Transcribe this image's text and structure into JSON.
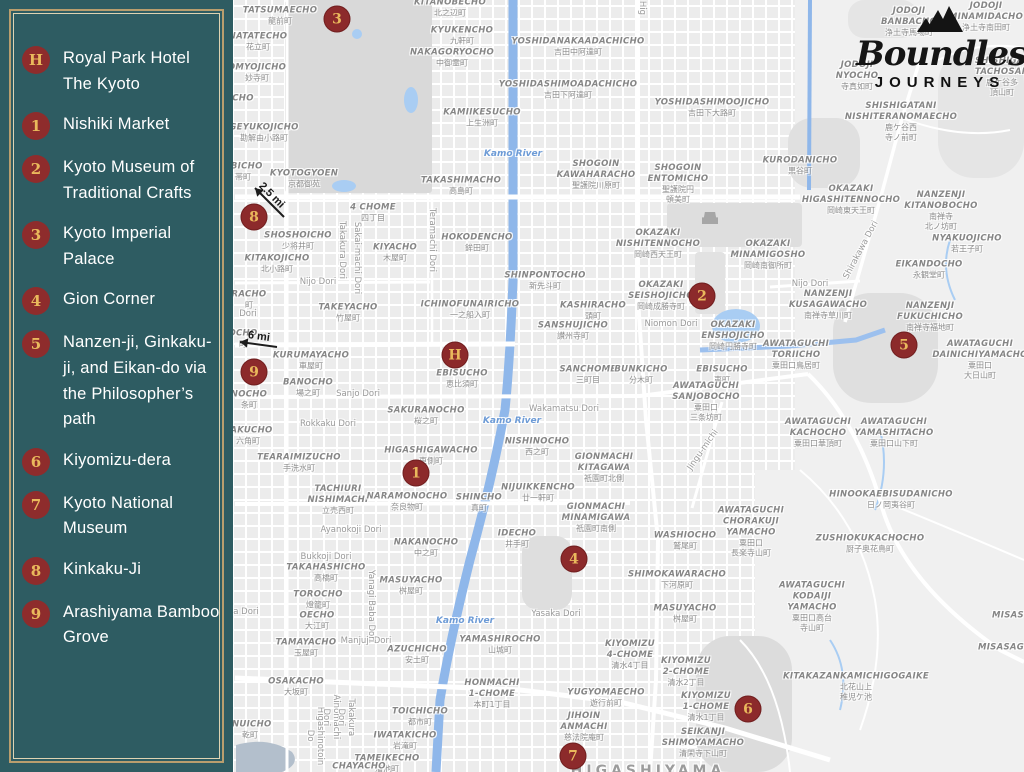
{
  "sidebar": {
    "items": [
      {
        "id": "H",
        "label": "Royal Park Hotel The Kyoto"
      },
      {
        "id": "1",
        "label": "Nishiki Market"
      },
      {
        "id": "2",
        "label": "Kyoto Museum of Traditional Crafts"
      },
      {
        "id": "3",
        "label": "Kyoto Imperial Palace"
      },
      {
        "id": "4",
        "label": "Gion Corner"
      },
      {
        "id": "5",
        "label": "Nanzen-ji, Ginkaku-ji, and Eikan-do via the Philosopher’s path"
      },
      {
        "id": "6",
        "label": "Kiyomizu-dera"
      },
      {
        "id": "7",
        "label": "Kyoto National Museum"
      },
      {
        "id": "8",
        "label": "Kinkaku-Ji"
      },
      {
        "id": "9",
        "label": "Arashiyama Bamboo Grove"
      }
    ]
  },
  "logo": {
    "line1": "Boundless",
    "line2": "JOURNEYS",
    "icon": "mountains-icon"
  },
  "colors": {
    "sidebar_bg": "#2e5c62",
    "frame_gold": "#b99e6e",
    "frame_inner": "#dfd3b2",
    "marker_red": "#8c2a2b",
    "marker_gold": "#eab95c",
    "label_gray": "#868686",
    "water_blue": "#8fb7ea",
    "road_white": "#ffffff",
    "park_gray": "#d9d9d9",
    "logo_black": "#151515"
  },
  "map": {
    "markers": [
      {
        "id": "3",
        "x": 337,
        "y": 19
      },
      {
        "id": "8",
        "x": 254,
        "y": 217
      },
      {
        "id": "9",
        "x": 254,
        "y": 372
      },
      {
        "id": "H",
        "x": 455,
        "y": 355
      },
      {
        "id": "2",
        "x": 702,
        "y": 296
      },
      {
        "id": "5",
        "x": 904,
        "y": 345
      },
      {
        "id": "1",
        "x": 416,
        "y": 473
      },
      {
        "id": "4",
        "x": 574,
        "y": 559
      },
      {
        "id": "6",
        "x": 748,
        "y": 709
      },
      {
        "id": "7",
        "x": 573,
        "y": 756
      }
    ],
    "arrows": [
      {
        "label": "2.5 mi",
        "tx": 284,
        "ty": 217,
        "hx": 255,
        "hy": 188
      },
      {
        "label": "6 mi",
        "tx": 277,
        "ty": 347,
        "hx": 240,
        "hy": 342
      }
    ],
    "labels": [
      {
        "en": "TATSUMAECHO",
        "jp": "龍前町",
        "x": 280,
        "y": 16,
        "t": "d"
      },
      {
        "en": "NATATECHO",
        "jp": "花立町",
        "x": 258,
        "y": 42,
        "t": "d"
      },
      {
        "en": "OMYOJICHO",
        "jp": "妙寺町",
        "x": 257,
        "y": 73,
        "t": "d"
      },
      {
        "en": "CHO",
        "x": 243,
        "y": 99,
        "t": "d"
      },
      {
        "en": "GEYUKOJICHO",
        "jp": "勘解由小路町",
        "x": 264,
        "y": 133,
        "t": "d"
      },
      {
        "en": "OBICHO",
        "jp": "帯町",
        "x": 243,
        "y": 172,
        "t": "d"
      },
      {
        "en": "KYOTOGYOEN",
        "jp": "京都御苑",
        "x": 304,
        "y": 179,
        "t": "d"
      },
      {
        "en": "KITANOBECHO",
        "jp": "北之辺町",
        "x": 450,
        "y": 8,
        "t": "d"
      },
      {
        "en": "KYUKENCHO",
        "jp": "九軒町",
        "x": 462,
        "y": 36,
        "t": "d"
      },
      {
        "en": "NAKAGORYOCHO",
        "jp": "中御霊町",
        "x": 452,
        "y": 58,
        "t": "d"
      },
      {
        "en": "YOSHIDANAKAADACHICHO",
        "jp": "吉田中阿達町",
        "x": 578,
        "y": 47,
        "t": "d"
      },
      {
        "en": "YOSHIDASHIMOADACHICHO",
        "jp": "吉田下阿達町",
        "x": 568,
        "y": 90,
        "t": "d"
      },
      {
        "en": "YOSHIDASHIMOOJICHO",
        "jp": "吉田下大路町",
        "x": 712,
        "y": 108,
        "t": "d"
      },
      {
        "en": "KAMIIKESUCHO",
        "jp": "上生洲町",
        "x": 482,
        "y": 118,
        "t": "d"
      },
      {
        "en": "Kamo River",
        "x": 513,
        "y": 154,
        "t": "w"
      },
      {
        "en": "TAKASHIMACHO",
        "jp": "高島町",
        "x": 461,
        "y": 186,
        "t": "d"
      },
      {
        "en": "SHOGOIN\nKAWAHARACHO",
        "jp": "聖護院川原町",
        "x": 596,
        "y": 175,
        "t": "d"
      },
      {
        "en": "SHOGOIN\nENTOMICHO",
        "jp": "聖護院円\n頓美町",
        "x": 678,
        "y": 184,
        "t": "d"
      },
      {
        "en": "KURODANICHO",
        "jp": "黒谷町",
        "x": 800,
        "y": 166,
        "t": "d"
      },
      {
        "en": "JODOJI\nBANBACHO",
        "jp": "浄土寺馬場町",
        "x": 909,
        "y": 22,
        "t": "d"
      },
      {
        "en": "JODOJI\nMINAMIDACHO",
        "jp": "浄土寺南田町",
        "x": 986,
        "y": 17,
        "t": "d"
      },
      {
        "en": "SHISHIGAT\nTACHOSAN",
        "jp": "鹿ケ谷多\n頂山町",
        "x": 1002,
        "y": 77,
        "t": "d"
      },
      {
        "en": "JODOJI\nNYOCHO",
        "jp": "寺真如町",
        "x": 857,
        "y": 76,
        "t": "d"
      },
      {
        "en": "SHISHIGATANI\nNISHITERANOMAECHO",
        "jp": "鹿ケ谷西\n寺ノ前町",
        "x": 901,
        "y": 122,
        "t": "d"
      },
      {
        "en": "OKAZAKI\nHIGASHITENNOCHO",
        "jp": "岡崎東天王町",
        "x": 851,
        "y": 200,
        "t": "d"
      },
      {
        "en": "NANZENJI\nKITANOBOCHO",
        "jp": "南禅寺\n北ノ坊町",
        "x": 941,
        "y": 211,
        "t": "d"
      },
      {
        "en": "NYAKUOJICHO",
        "jp": "若王子町",
        "x": 967,
        "y": 244,
        "t": "d"
      },
      {
        "en": "EIKANDOCHO",
        "jp": "永観堂町",
        "x": 929,
        "y": 270,
        "t": "d"
      },
      {
        "en": "NANZENJI\nKUSAGAWACHO",
        "jp": "南禅寺草川町",
        "x": 828,
        "y": 305,
        "t": "d"
      },
      {
        "en": "NANZENJI\nFUKUCHICHO",
        "jp": "南禅寺福地町",
        "x": 930,
        "y": 317,
        "t": "d"
      },
      {
        "en": "AWATAGUCHI\nDAINICHIYAMACHO",
        "jp": "粟田口\n大日山町",
        "x": 980,
        "y": 360,
        "t": "d"
      },
      {
        "en": "AWATAGUCHI\nTORIICHO",
        "jp": "粟田口鳥居町",
        "x": 796,
        "y": 355,
        "t": "d"
      },
      {
        "en": "AWATAGUCHI\nKACHOCHO",
        "jp": "粟田口華頂町",
        "x": 818,
        "y": 433,
        "t": "d"
      },
      {
        "en": "AWATAGUCHI\nYAMASHITACHO",
        "jp": "粟田口山下町",
        "x": 894,
        "y": 433,
        "t": "d"
      },
      {
        "en": "HINOOKAEBISUDANICHO",
        "jp": "日ノ岡夷谷町",
        "x": 891,
        "y": 500,
        "t": "d"
      },
      {
        "en": "ZUSHIOKUKACHOCHO",
        "jp": "厨子奥花鳥町",
        "x": 870,
        "y": 544,
        "t": "d"
      },
      {
        "en": "AWATAGUCHI\nKODAIJI\nYAMACHO",
        "jp": "粟田口高台\n寺山町",
        "x": 812,
        "y": 607,
        "t": "d"
      },
      {
        "en": "MISAS",
        "x": 1008,
        "y": 616,
        "t": "d"
      },
      {
        "en": "MISASAG",
        "x": 1001,
        "y": 648,
        "t": "d"
      },
      {
        "en": "KITAKAZANKAMICHIGOGAIKE",
        "jp": "北花山上\n稚児ケ池",
        "x": 856,
        "y": 687,
        "t": "d"
      },
      {
        "en": "SHINPONTOCHO",
        "jp": "新先斗町",
        "x": 545,
        "y": 281,
        "t": "d"
      },
      {
        "en": "OKAZAKI\nNISHITENNOCHO",
        "jp": "岡崎西天王町",
        "x": 658,
        "y": 244,
        "t": "d"
      },
      {
        "en": "OKAZAKI\nMINAMIGOSHO",
        "jp": "岡崎南御所町",
        "x": 768,
        "y": 255,
        "t": "d"
      },
      {
        "en": "OKAZAKI\nSEISHOJICHO",
        "jp": "岡崎成勝寺町",
        "x": 661,
        "y": 296,
        "t": "d"
      },
      {
        "en": "KASHIRACHO",
        "jp": "頭町",
        "x": 593,
        "y": 311,
        "t": "d"
      },
      {
        "en": "SANSHUJICHO",
        "jp": "讃州寺町",
        "x": 573,
        "y": 331,
        "t": "d"
      },
      {
        "en": "Niomon Dori",
        "x": 671,
        "y": 324,
        "t": "r"
      },
      {
        "en": "OKAZAKI\nENSHOJICHO",
        "jp": "岡崎円勝寺町",
        "x": 733,
        "y": 336,
        "t": "d"
      },
      {
        "en": "SANCHOME",
        "jp": "三町目",
        "x": 588,
        "y": 375,
        "t": "d"
      },
      {
        "en": "BUNKICHO",
        "jp": "分木町",
        "x": 641,
        "y": 375,
        "t": "d"
      },
      {
        "en": "EBISUCHO",
        "jp": "夷町",
        "x": 722,
        "y": 375,
        "t": "d"
      },
      {
        "en": "AWATAGUCHI\nSANJOBOCHO",
        "jp": "粟田口\n三条坊町",
        "x": 706,
        "y": 402,
        "t": "d"
      },
      {
        "en": "Wakamatsu Dori",
        "x": 564,
        "y": 409,
        "t": "r"
      },
      {
        "en": "4 CHOME",
        "jp": "四丁目",
        "x": 373,
        "y": 213,
        "t": "d"
      },
      {
        "en": "SHOSHOICHO",
        "jp": "少将井町",
        "x": 298,
        "y": 241,
        "t": "d"
      },
      {
        "en": "KITAKOJICHO",
        "jp": "北小路町",
        "x": 277,
        "y": 264,
        "t": "d"
      },
      {
        "en": "Nijo Dori",
        "x": 318,
        "y": 282,
        "t": "r"
      },
      {
        "en": "Nijo Dori",
        "x": 810,
        "y": 284,
        "t": "r"
      },
      {
        "en": "KIYACHO",
        "jp": "木屋町",
        "x": 395,
        "y": 253,
        "t": "d"
      },
      {
        "en": "HOKODENCHO",
        "jp": "鉾田町",
        "x": 477,
        "y": 243,
        "t": "d"
      },
      {
        "en": "TAKEYACHO",
        "jp": "竹屋町",
        "x": 348,
        "y": 313,
        "t": "d"
      },
      {
        "en": "ICHINOFUNAIRICHO",
        "jp": "一之船入町",
        "x": 470,
        "y": 310,
        "t": "d"
      },
      {
        "en": "KURUMAYACHO",
        "jp": "車屋町",
        "x": 311,
        "y": 361,
        "t": "d"
      },
      {
        "en": "BANOCHO",
        "jp": "場之町",
        "x": 308,
        "y": 388,
        "t": "d"
      },
      {
        "en": "Sanjo Dori",
        "x": 358,
        "y": 394,
        "t": "r"
      },
      {
        "en": "EBISUCHO",
        "jp": "恵比須町",
        "x": 462,
        "y": 379,
        "t": "d"
      },
      {
        "en": "RACHO",
        "jp": "町",
        "x": 249,
        "y": 300,
        "t": "d"
      },
      {
        "en": "Dori",
        "x": 248,
        "y": 314,
        "t": "r"
      },
      {
        "en": "OCHO",
        "jp": "町",
        "x": 243,
        "y": 339,
        "t": "d"
      },
      {
        "en": "NOCHO",
        "jp": "条町",
        "x": 249,
        "y": 400,
        "t": "d"
      },
      {
        "en": "SAKURANOCHO",
        "jp": "桜之町",
        "x": 426,
        "y": 416,
        "t": "d"
      },
      {
        "en": "Rokkaku Dori",
        "x": 328,
        "y": 424,
        "t": "r"
      },
      {
        "en": "KAKUCHO",
        "jp": "六角町",
        "x": 248,
        "y": 436,
        "t": "d"
      },
      {
        "en": "TEARAIMIZUCHO",
        "jp": "手洗水町",
        "x": 299,
        "y": 463,
        "t": "d"
      },
      {
        "en": "HIGASHIGAWACHO",
        "jp": "東側町",
        "x": 431,
        "y": 456,
        "t": "d"
      },
      {
        "en": "Kamo River",
        "x": 512,
        "y": 421,
        "t": "w"
      },
      {
        "en": "TACHIURI\nNISHIMACHI",
        "jp": "立売西町",
        "x": 338,
        "y": 500,
        "t": "d"
      },
      {
        "en": "NARAMONOCHO",
        "jp": "奈良物町",
        "x": 407,
        "y": 502,
        "t": "d"
      },
      {
        "en": "SHINCHO",
        "jp": "真町",
        "x": 479,
        "y": 503,
        "t": "d"
      },
      {
        "en": "Ayanokoji Dori",
        "x": 351,
        "y": 530,
        "t": "r"
      },
      {
        "en": "NAKANOCHO",
        "jp": "中之町",
        "x": 426,
        "y": 548,
        "t": "d"
      },
      {
        "en": "Bukkoji Dori",
        "x": 326,
        "y": 557,
        "t": "r"
      },
      {
        "en": "TAKAHASHICHO",
        "jp": "高橋町",
        "x": 326,
        "y": 573,
        "t": "d"
      },
      {
        "en": "MASUYACHO",
        "jp": "桝屋町",
        "x": 411,
        "y": 586,
        "t": "d"
      },
      {
        "en": "TOROCHO",
        "jp": "燈籠町",
        "x": 318,
        "y": 600,
        "t": "d"
      },
      {
        "en": "OECHO",
        "jp": "大江町",
        "x": 317,
        "y": 621,
        "t": "d"
      },
      {
        "en": "TAMAYACHO",
        "jp": "玉屋町",
        "x": 306,
        "y": 648,
        "t": "d"
      },
      {
        "en": "Manjuji Dori",
        "x": 366,
        "y": 641,
        "t": "r"
      },
      {
        "en": "AZUCHICHO",
        "jp": "安土町",
        "x": 417,
        "y": 655,
        "t": "d"
      },
      {
        "en": "Kamo River",
        "x": 465,
        "y": 621,
        "t": "w"
      },
      {
        "en": "YAMASHIROCHO",
        "jp": "山城町",
        "x": 500,
        "y": 645,
        "t": "d"
      },
      {
        "en": "a Dori",
        "x": 246,
        "y": 612,
        "t": "r"
      },
      {
        "en": "OSAKACHO",
        "jp": "大坂町",
        "x": 296,
        "y": 687,
        "t": "d"
      },
      {
        "en": "HONMACHI\n1-CHOME",
        "jp": "本町1丁目",
        "x": 492,
        "y": 694,
        "t": "d"
      },
      {
        "en": "TOICHICHO",
        "jp": "都市町",
        "x": 420,
        "y": 717,
        "t": "d"
      },
      {
        "en": "IWATAKICHO",
        "jp": "岩滝町",
        "x": 405,
        "y": 741,
        "t": "d"
      },
      {
        "en": "TAMEIKECHO",
        "jp": "溜池町",
        "x": 387,
        "y": 764,
        "t": "d"
      },
      {
        "en": "INUICHO",
        "jp": "乾町",
        "x": 250,
        "y": 730,
        "t": "d"
      },
      {
        "en": "CHAYACHO",
        "x": 359,
        "y": 767,
        "t": "d"
      },
      {
        "en": "NISHINOCHO",
        "jp": "西之町",
        "x": 537,
        "y": 447,
        "t": "d"
      },
      {
        "en": "GIONMACHI\nKITAGAWA",
        "jp": "祇園町北側",
        "x": 604,
        "y": 468,
        "t": "d"
      },
      {
        "en": "NIJUIKKENCHO",
        "jp": "廿一軒町",
        "x": 538,
        "y": 493,
        "t": "d"
      },
      {
        "en": "GIONMACHI\nMINAMIGAWA",
        "jp": "祇園町南側",
        "x": 596,
        "y": 518,
        "t": "d"
      },
      {
        "en": "IDECHO",
        "jp": "井手町",
        "x": 517,
        "y": 539,
        "t": "d"
      },
      {
        "en": "WASHIOCHO",
        "jp": "鷲尾町",
        "x": 685,
        "y": 541,
        "t": "d"
      },
      {
        "en": "AWATAGUCHI\nCHORAKUJI\nYAMACHO",
        "jp": "粟田口\n長楽寺山町",
        "x": 751,
        "y": 532,
        "t": "d"
      },
      {
        "en": "SHIMOKAWARACHO",
        "jp": "下河原町",
        "x": 677,
        "y": 580,
        "t": "d"
      },
      {
        "en": "MASUYACHO",
        "jp": "桝屋町",
        "x": 685,
        "y": 614,
        "t": "d"
      },
      {
        "en": "Yasaka Dori",
        "x": 556,
        "y": 614,
        "t": "r"
      },
      {
        "en": "KIYOMIZU\n4-CHOME",
        "jp": "清水4丁目",
        "x": 630,
        "y": 655,
        "t": "d"
      },
      {
        "en": "KIYOMIZU\n2-CHOME",
        "jp": "清水2丁目",
        "x": 686,
        "y": 672,
        "t": "d"
      },
      {
        "en": "YUGYOMAECHO",
        "jp": "遊行前町",
        "x": 606,
        "y": 698,
        "t": "d"
      },
      {
        "en": "JIHOIN\nANMACHI",
        "jp": "慈法院庵町",
        "x": 584,
        "y": 727,
        "t": "d"
      },
      {
        "en": "KIYOMIZU\n1-CHOME",
        "jp": "清水1丁目",
        "x": 706,
        "y": 707,
        "t": "d"
      },
      {
        "en": "SEIKANJI\nSHIMOYAMACHO",
        "jp": "清閑寺下山町",
        "x": 703,
        "y": 743,
        "t": "d"
      },
      {
        "en": "HIGASHIYAMA",
        "x": 648,
        "y": 771,
        "t": "big"
      },
      {
        "en": "Hig",
        "x": 642,
        "y": 8,
        "t": "rv"
      },
      {
        "en": "Teramachi Dori",
        "x": 432,
        "y": 240,
        "t": "rv"
      },
      {
        "en": "Takakura Dori",
        "x": 342,
        "y": 250,
        "t": "rv"
      },
      {
        "en": "Sakai-machi Dori",
        "x": 357,
        "y": 258,
        "t": "rv"
      },
      {
        "en": "Yanagi Baba Dori",
        "x": 371,
        "y": 606,
        "t": "rv"
      },
      {
        "en": "Higashinotoin Do",
        "x": 315,
        "y": 736,
        "t": "rv"
      },
      {
        "en": "Ainomachi Dori",
        "x": 331,
        "y": 717,
        "t": "rv"
      },
      {
        "en": "Takakura Dori",
        "x": 346,
        "y": 717,
        "t": "rv"
      },
      {
        "en": "Shirakawa Dori",
        "x": 861,
        "y": 250,
        "t": "rd",
        "a": -62
      },
      {
        "en": "Jingu-michi",
        "x": 703,
        "y": 450,
        "t": "rd",
        "a": -55
      }
    ]
  }
}
